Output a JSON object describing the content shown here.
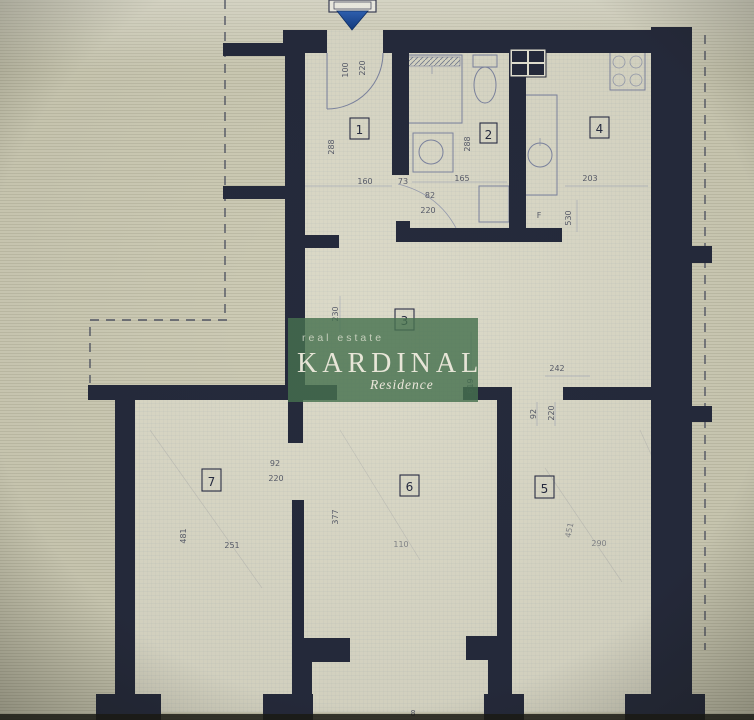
{
  "plan": {
    "type": "apartment-floor-plan"
  },
  "watermark": {
    "tagline": "real estate",
    "brand": "KARDINAL",
    "subtitle": "Residence"
  },
  "colors": {
    "wall": "#252a3c",
    "paper": "#cfcdb7",
    "interior": "#dcdac8",
    "accent_blue": "#1d4f9e",
    "watermark_green": "#47714f",
    "dim_text": "#3c4156"
  },
  "rooms": {
    "r1": "1",
    "r2": "2",
    "r3": "3",
    "r4": "4",
    "r5": "5",
    "r6": "6",
    "r7": "7"
  },
  "dims": {
    "entrance_width": "100",
    "entrance_height": "220",
    "room1_side": "288",
    "room1_bottom": "160",
    "hall_door": "73",
    "bath_door_width": "82",
    "bath_door_height": "220",
    "bath_bottom": "165",
    "bath_side": "288",
    "kitchen_width": "203",
    "kitchen_depth": "530",
    "kitchen_f": "F",
    "hall_side": "230",
    "hall_length": "619",
    "room3_width": "242",
    "room5_door_width": "92",
    "room5_door_height": "220",
    "room7_door_width": "92",
    "room7_door_height": "220",
    "room6_wall": "377",
    "room7_height": "481",
    "room7_width": "251",
    "room6_width": "110",
    "room5_height": "451",
    "room5_width": "290",
    "bottom_mark": "8"
  }
}
